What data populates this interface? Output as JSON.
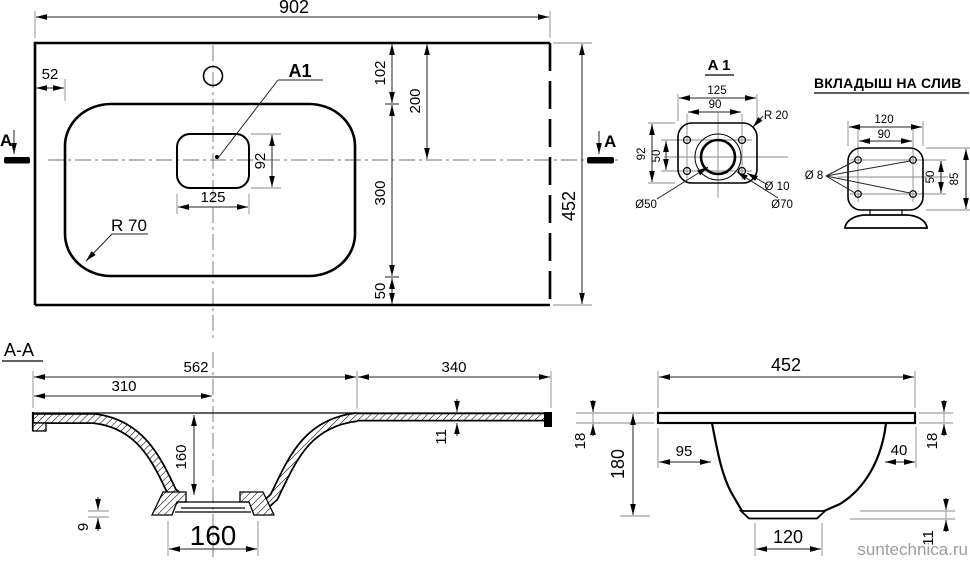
{
  "plan": {
    "dim_width": "902",
    "dim_left_offset": "52",
    "detail_label": "A1",
    "dim_top_to_basin": "102",
    "dim_top_to_center": "200",
    "dim_basin_height": "300",
    "dim_basin_to_edge": "50",
    "dim_height": "452",
    "dim_cutout_height": "92",
    "dim_cutout_width": "125",
    "radius_label": "R 70",
    "section_letter": "A"
  },
  "detail_a1": {
    "title": "A 1",
    "dim_width": "125",
    "dim_hole_span_w": "90",
    "dim_height": "92",
    "dim_hole_span_h": "50",
    "radius_label": "R 20",
    "hole_label": "Ø 10",
    "inner_circle_label": "Ø50",
    "outer_circle_label": "Ø70"
  },
  "insert": {
    "title": "ВКЛАДЫШ НА СЛИВ",
    "dim_width": "120",
    "dim_hole_span_w": "90",
    "dim_height": "85",
    "dim_hole_span_h": "50",
    "hole_label": "Ø 8"
  },
  "section_aa": {
    "title": "A-A",
    "dim_left_span": "562",
    "dim_right_span": "340",
    "dim_center_span": "310",
    "dim_depth": "160",
    "dim_drain_width": "160",
    "dim_wall_thickness": "9",
    "dim_slab_thickness": "11"
  },
  "side_section": {
    "dim_width": "452",
    "dim_slab_left": "18",
    "dim_height": "180",
    "dim_left_inset": "95",
    "dim_right_inset": "40",
    "dim_slab_right": "18",
    "dim_bottom_width": "120",
    "dim_plate_thickness": "11"
  },
  "watermark": "suntechnica.ru"
}
